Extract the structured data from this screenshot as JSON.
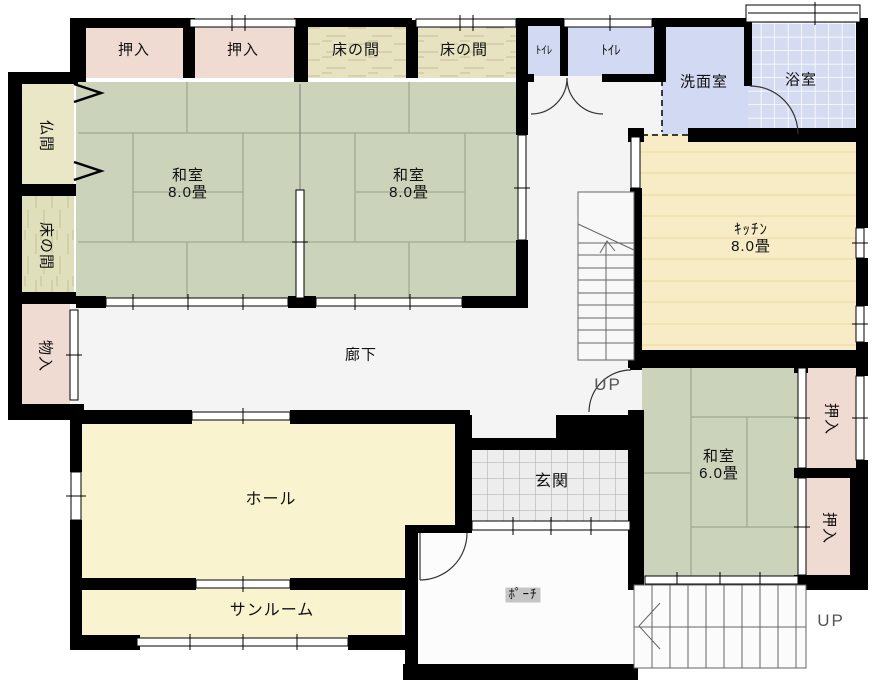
{
  "rooms": [
    {
      "id": "oshiire-top-1",
      "label": "押入"
    },
    {
      "id": "oshiire-top-2",
      "label": "押入"
    },
    {
      "id": "tokonoma-top-1",
      "label": "床の間"
    },
    {
      "id": "tokonoma-top-2",
      "label": "床の間"
    },
    {
      "id": "toilet-1",
      "label": "ﾄｲﾚ"
    },
    {
      "id": "toilet-2",
      "label": "ﾄｲﾚ"
    },
    {
      "id": "washroom",
      "label": "洗面室"
    },
    {
      "id": "bath",
      "label": "浴室"
    },
    {
      "id": "butsuma",
      "label": "仏間"
    },
    {
      "id": "tokonoma-left",
      "label": "床の間"
    },
    {
      "id": "storage",
      "label": "物入"
    },
    {
      "id": "washitsu-1",
      "label": "和室",
      "size": "8.0畳"
    },
    {
      "id": "washitsu-2",
      "label": "和室",
      "size": "8.0畳"
    },
    {
      "id": "kitchen",
      "label": "ｷｯﾁﾝ",
      "size": "8.0畳"
    },
    {
      "id": "corridor",
      "label": "廊下"
    },
    {
      "id": "washitsu-3",
      "label": "和室",
      "size": "6.0畳"
    },
    {
      "id": "oshiire-right-1",
      "label": "押入"
    },
    {
      "id": "oshiire-right-2",
      "label": "押入"
    },
    {
      "id": "hall",
      "label": "ホール"
    },
    {
      "id": "sunroom",
      "label": "サンルーム"
    },
    {
      "id": "genkan",
      "label": "玄関"
    },
    {
      "id": "porch",
      "label": "ﾎﾟｰﾁ"
    },
    {
      "id": "stairs-center",
      "label": "UP"
    },
    {
      "id": "stairs-bottom",
      "label": "UP"
    }
  ],
  "colors": {
    "wall": "#000000",
    "tatami": "#CBD3BA",
    "tatamiLine": "#9FA88F",
    "closet": "#EFDBD1",
    "tokonoma": "#E7E3C0",
    "tokonomaLeft": "#DFE0BB",
    "grain": "#C6BF97",
    "butsuma": "#EAE7C6",
    "water": "#D2D9F3",
    "bath": "#D5DCF2",
    "kitchen": "#F8ECC6",
    "kitchenLine": "#E7D7A3",
    "hall": "#FAF3CF",
    "genkan": "#EDEDED",
    "tileLine": "#A9A9A9",
    "corridor": "#F4F4F4",
    "porch": "#FCFCFC",
    "stairLine": "#666666",
    "doorArc": "#333333",
    "upText": "#555555",
    "labelBg": "#C5C5C5"
  }
}
